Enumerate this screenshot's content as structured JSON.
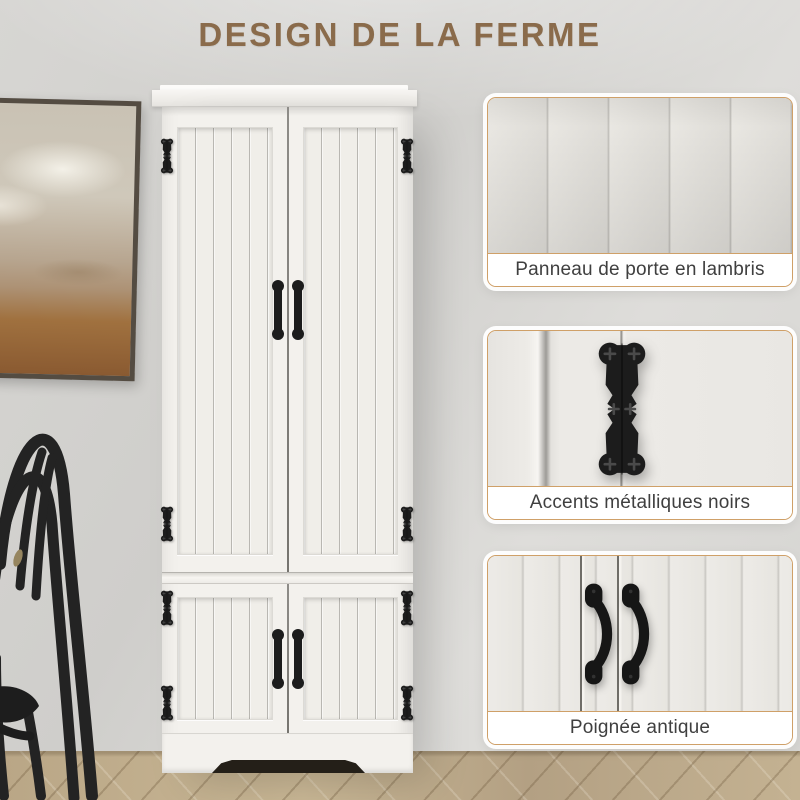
{
  "header": {
    "title": "DESIGN DE LA FERME"
  },
  "features": [
    {
      "caption": "Panneau de porte en lambris",
      "icon": "paneled-door-swatch"
    },
    {
      "caption": "Accents métalliques noirs",
      "icon": "black-hinge-swatch"
    },
    {
      "caption": "Poignée antique",
      "icon": "antique-handle-swatch"
    }
  ],
  "colors": {
    "title_brown": "#8a6b4b",
    "card_border_tan": "#cfa068",
    "hardware_black": "#1c1c1c",
    "cabinet_white": "#f3f1ed",
    "wall_gray": "#d9d8d5",
    "floor_wood": "#bfae8e",
    "caption_text": "#3f3f3f"
  }
}
